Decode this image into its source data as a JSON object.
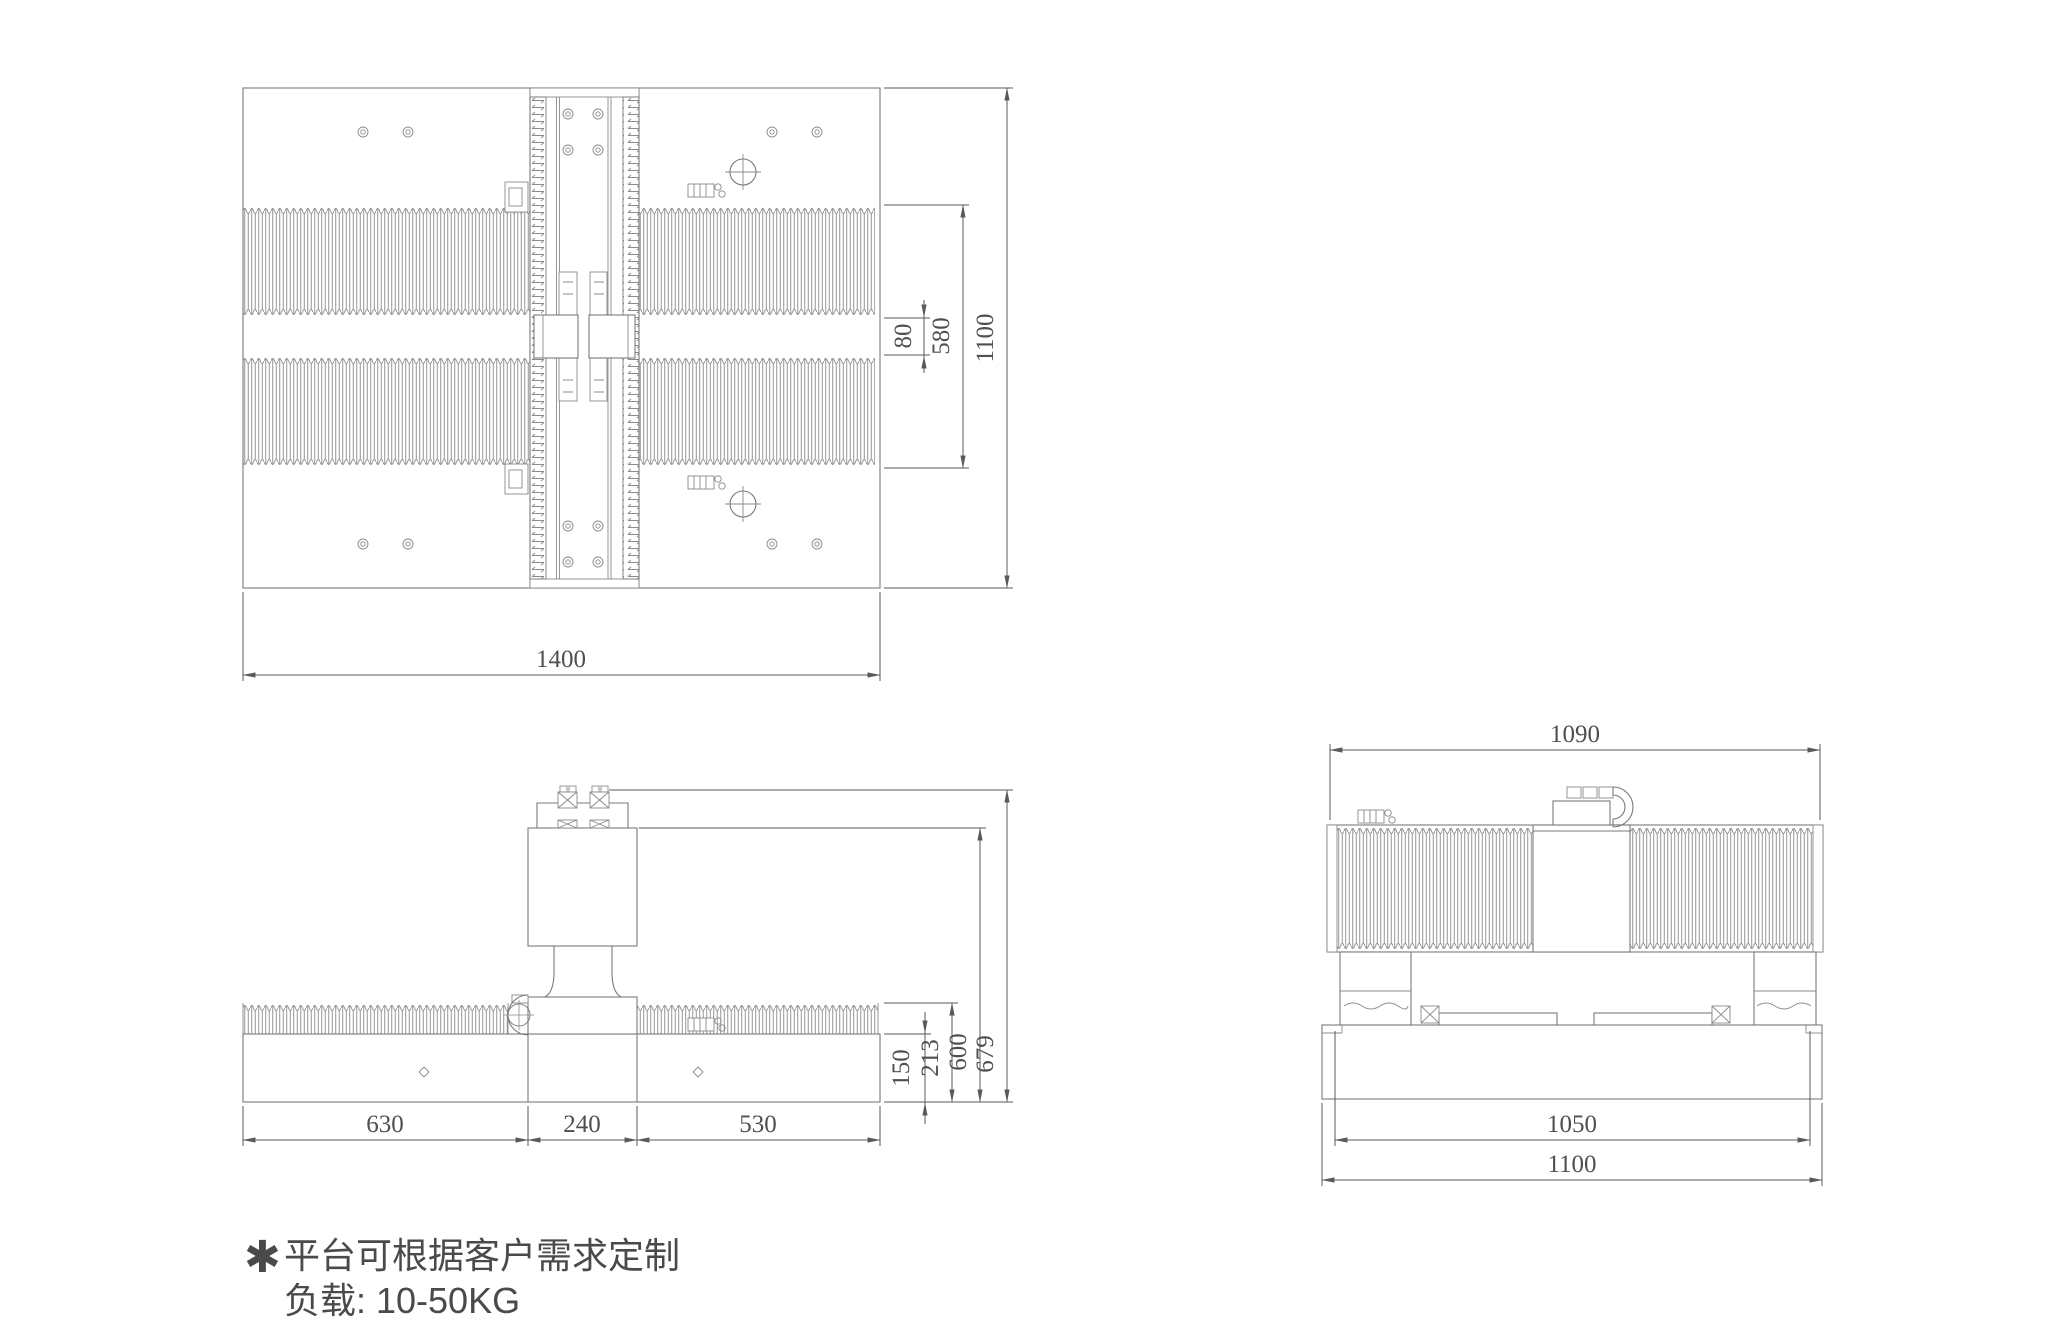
{
  "drawing": {
    "type": "mechanical-engineering-drawing",
    "colors": {
      "line": "#7a7a7a",
      "dimension": "#5a5a5a",
      "note_text": "#4a4a4a",
      "background": "#ffffff"
    },
    "dimensions": {
      "top": {
        "width": "1400",
        "height": "1100",
        "bellows_span": "580",
        "center_gap": "80"
      },
      "front": {
        "seg_left": "630",
        "seg_center": "240",
        "seg_right": "530",
        "base_height": "150",
        "bellows_height": "213",
        "box_height": "600",
        "overall_height": "679"
      },
      "side": {
        "top_width": "1090",
        "inner_width": "1050",
        "base_width": "1100"
      }
    },
    "notes": {
      "bullet": "✱",
      "line1": "平台可根据客户需求定制",
      "line2": "负载: 10-50KG"
    }
  }
}
